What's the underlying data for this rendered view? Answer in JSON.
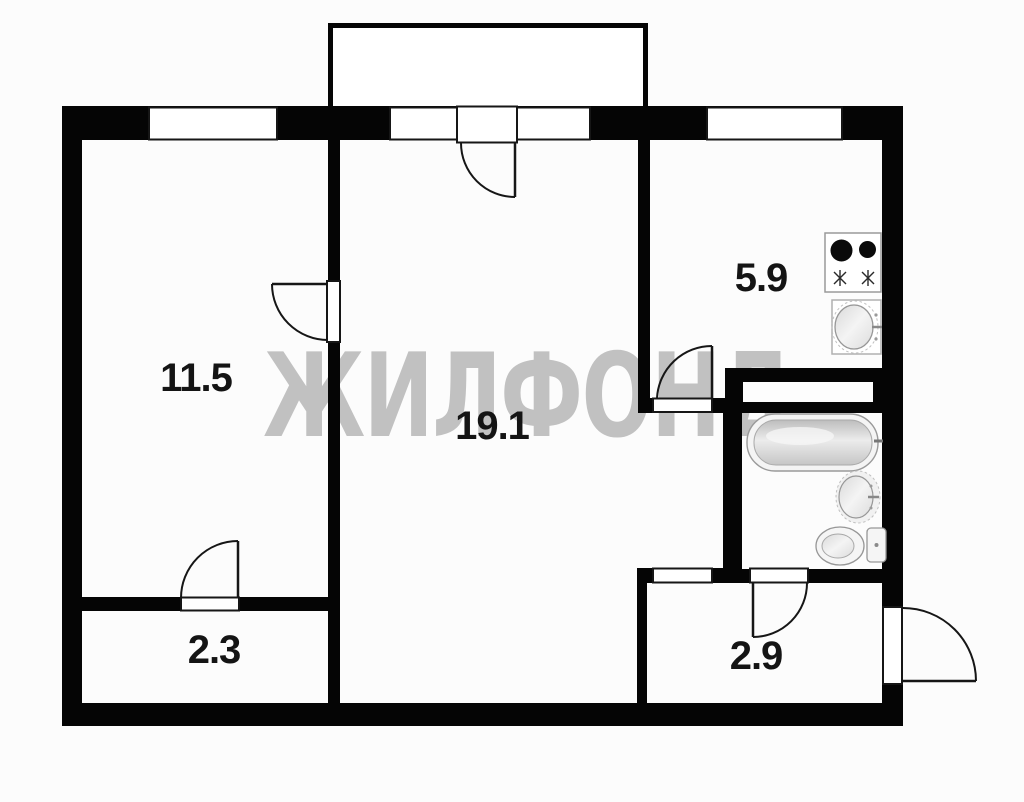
{
  "watermark": {
    "text": "ЖИЛФОНД",
    "color": "#bdbdbd"
  },
  "rooms": [
    {
      "name": "room-left",
      "label": "11.5"
    },
    {
      "name": "living-room",
      "label": "19.1"
    },
    {
      "name": "kitchen",
      "label": "5.9"
    },
    {
      "name": "storage",
      "label": "2.3"
    },
    {
      "name": "hallway",
      "label": "2.9"
    }
  ],
  "fixtures": [
    "stove-icon",
    "kitchen-sink-icon",
    "bathtub-icon",
    "washbasin-icon",
    "toilet-icon"
  ],
  "colors": {
    "wall": "#050505",
    "background": "#fcfcfc",
    "line": "#161616",
    "watermark": "#bdbdbd"
  }
}
